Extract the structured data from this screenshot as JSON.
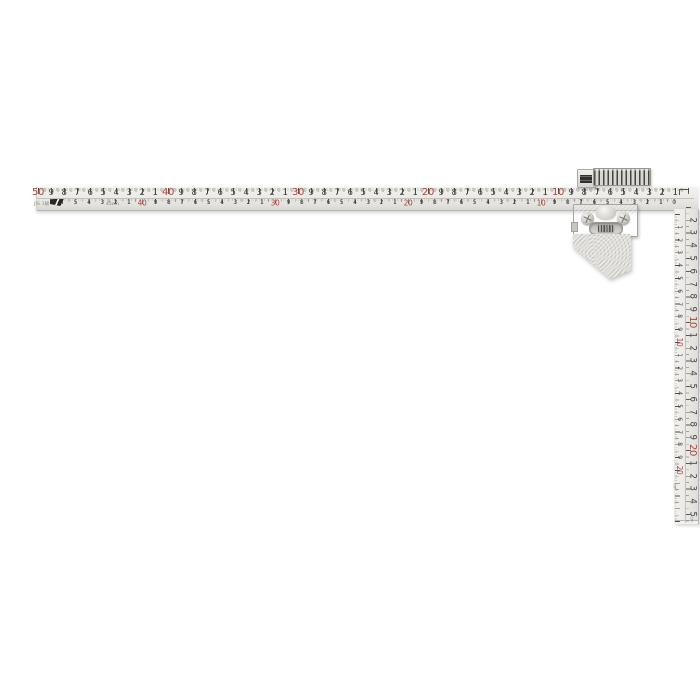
{
  "colors": {
    "accent_red": "#a8463f",
    "ink": "#44423f",
    "metal_light": "#f1f0ec",
    "metal_dark": "#c9c8c3"
  },
  "fine_print": {
    "jis_mark": "JIS 1級",
    "length_mark": "45cm",
    "unit_label": "cm"
  },
  "scales": {
    "horizontal_top": [
      [
        50,
        "50",
        1
      ],
      [
        49,
        "9",
        0
      ],
      [
        48,
        "8",
        0
      ],
      [
        47,
        "7",
        0
      ],
      [
        46,
        "6",
        0
      ],
      [
        45,
        "5",
        0
      ],
      [
        44,
        "4",
        0
      ],
      [
        43,
        "3",
        0
      ],
      [
        42,
        "2",
        0
      ],
      [
        41,
        "1",
        0
      ],
      [
        40,
        "40",
        1
      ],
      [
        39,
        "9",
        0
      ],
      [
        38,
        "8",
        0
      ],
      [
        37,
        "7",
        0
      ],
      [
        36,
        "6",
        0
      ],
      [
        35,
        "5",
        0
      ],
      [
        34,
        "4",
        0
      ],
      [
        33,
        "3",
        0
      ],
      [
        32,
        "2",
        0
      ],
      [
        31,
        "1",
        0
      ],
      [
        30,
        "30",
        1
      ],
      [
        29,
        "9",
        0
      ],
      [
        28,
        "8",
        0
      ],
      [
        27,
        "7",
        0
      ],
      [
        26,
        "6",
        0
      ],
      [
        25,
        "5",
        0
      ],
      [
        24,
        "4",
        0
      ],
      [
        23,
        "3",
        0
      ],
      [
        22,
        "2",
        0
      ],
      [
        21,
        "1",
        0
      ],
      [
        20,
        "20",
        1
      ],
      [
        19,
        "9",
        0
      ],
      [
        18,
        "8",
        0
      ],
      [
        17,
        "7",
        0
      ],
      [
        16,
        "6",
        0
      ],
      [
        15,
        "5",
        0
      ],
      [
        14,
        "4",
        0
      ],
      [
        13,
        "3",
        0
      ],
      [
        12,
        "2",
        0
      ],
      [
        11,
        "1",
        0
      ],
      [
        10,
        "10",
        1
      ],
      [
        9,
        "9",
        0
      ],
      [
        8,
        "8",
        0
      ],
      [
        7,
        "7",
        0
      ],
      [
        6,
        "6",
        0
      ],
      [
        5,
        "5",
        0
      ],
      [
        4,
        "4",
        0
      ],
      [
        3,
        "3",
        0
      ],
      [
        2,
        "2",
        0
      ],
      [
        1,
        "1",
        0
      ]
    ],
    "horizontal_bottom": [
      [
        45,
        "5",
        0
      ],
      [
        44,
        "4",
        0
      ],
      [
        43,
        "3",
        0
      ],
      [
        42,
        "2",
        0
      ],
      [
        41,
        "1",
        0
      ],
      [
        40,
        "40",
        1
      ],
      [
        39,
        "9",
        0
      ],
      [
        38,
        "8",
        0
      ],
      [
        37,
        "7",
        0
      ],
      [
        36,
        "6",
        0
      ],
      [
        35,
        "5",
        0
      ],
      [
        34,
        "4",
        0
      ],
      [
        33,
        "3",
        0
      ],
      [
        32,
        "2",
        0
      ],
      [
        31,
        "1",
        0
      ],
      [
        30,
        "30",
        1
      ],
      [
        29,
        "9",
        0
      ],
      [
        28,
        "8",
        0
      ],
      [
        27,
        "7",
        0
      ],
      [
        26,
        "6",
        0
      ],
      [
        25,
        "5",
        0
      ],
      [
        24,
        "4",
        0
      ],
      [
        23,
        "3",
        0
      ],
      [
        22,
        "2",
        0
      ],
      [
        21,
        "1",
        0
      ],
      [
        20,
        "20",
        1
      ],
      [
        19,
        "9",
        0
      ],
      [
        18,
        "8",
        0
      ],
      [
        17,
        "7",
        0
      ],
      [
        16,
        "6",
        0
      ],
      [
        15,
        "5",
        0
      ],
      [
        14,
        "4",
        0
      ],
      [
        13,
        "3",
        0
      ],
      [
        12,
        "2",
        0
      ],
      [
        11,
        "1",
        0
      ],
      [
        10,
        "10",
        1
      ],
      [
        9,
        "9",
        0
      ],
      [
        8,
        "8",
        0
      ],
      [
        7,
        "7",
        0
      ],
      [
        6,
        "6",
        0
      ],
      [
        5,
        "5",
        0
      ],
      [
        4,
        "4",
        0
      ],
      [
        3,
        "3",
        0
      ],
      [
        2,
        "2",
        0
      ],
      [
        1,
        "1",
        0
      ],
      [
        0,
        "0",
        0
      ]
    ],
    "vertical_outer": [
      [
        2,
        "2",
        0
      ],
      [
        3,
        "3",
        0
      ],
      [
        4,
        "4",
        0
      ],
      [
        5,
        "5",
        0
      ],
      [
        6,
        "6",
        0
      ],
      [
        7,
        "7",
        0
      ],
      [
        8,
        "8",
        0
      ],
      [
        9,
        "9",
        0
      ],
      [
        10,
        "10",
        1
      ],
      [
        11,
        "1",
        0
      ],
      [
        12,
        "2",
        0
      ],
      [
        13,
        "3",
        0
      ],
      [
        14,
        "4",
        0
      ],
      [
        15,
        "5",
        0
      ],
      [
        16,
        "6",
        0
      ],
      [
        17,
        "7",
        0
      ],
      [
        18,
        "8",
        0
      ],
      [
        19,
        "9",
        0
      ],
      [
        20,
        "20",
        1
      ],
      [
        21,
        "1",
        0
      ],
      [
        22,
        "2",
        0
      ],
      [
        23,
        "3",
        0
      ],
      [
        24,
        "4",
        0
      ],
      [
        25,
        "5",
        0
      ]
    ],
    "vertical_inner": [
      [
        1,
        "1",
        0
      ],
      [
        2,
        "2",
        0
      ],
      [
        3,
        "3",
        0
      ],
      [
        4,
        "4",
        0
      ],
      [
        5,
        "5",
        0
      ],
      [
        6,
        "6",
        0
      ],
      [
        7,
        "7",
        0
      ],
      [
        8,
        "8",
        0
      ],
      [
        9,
        "9",
        0
      ],
      [
        10,
        "10",
        1
      ],
      [
        11,
        "1",
        0
      ],
      [
        12,
        "2",
        0
      ],
      [
        13,
        "3",
        0
      ],
      [
        14,
        "4",
        0
      ],
      [
        15,
        "5",
        0
      ],
      [
        16,
        "6",
        0
      ],
      [
        17,
        "7",
        0
      ],
      [
        18,
        "8",
        0
      ],
      [
        19,
        "9",
        0
      ],
      [
        20,
        "20",
        1
      ]
    ]
  }
}
